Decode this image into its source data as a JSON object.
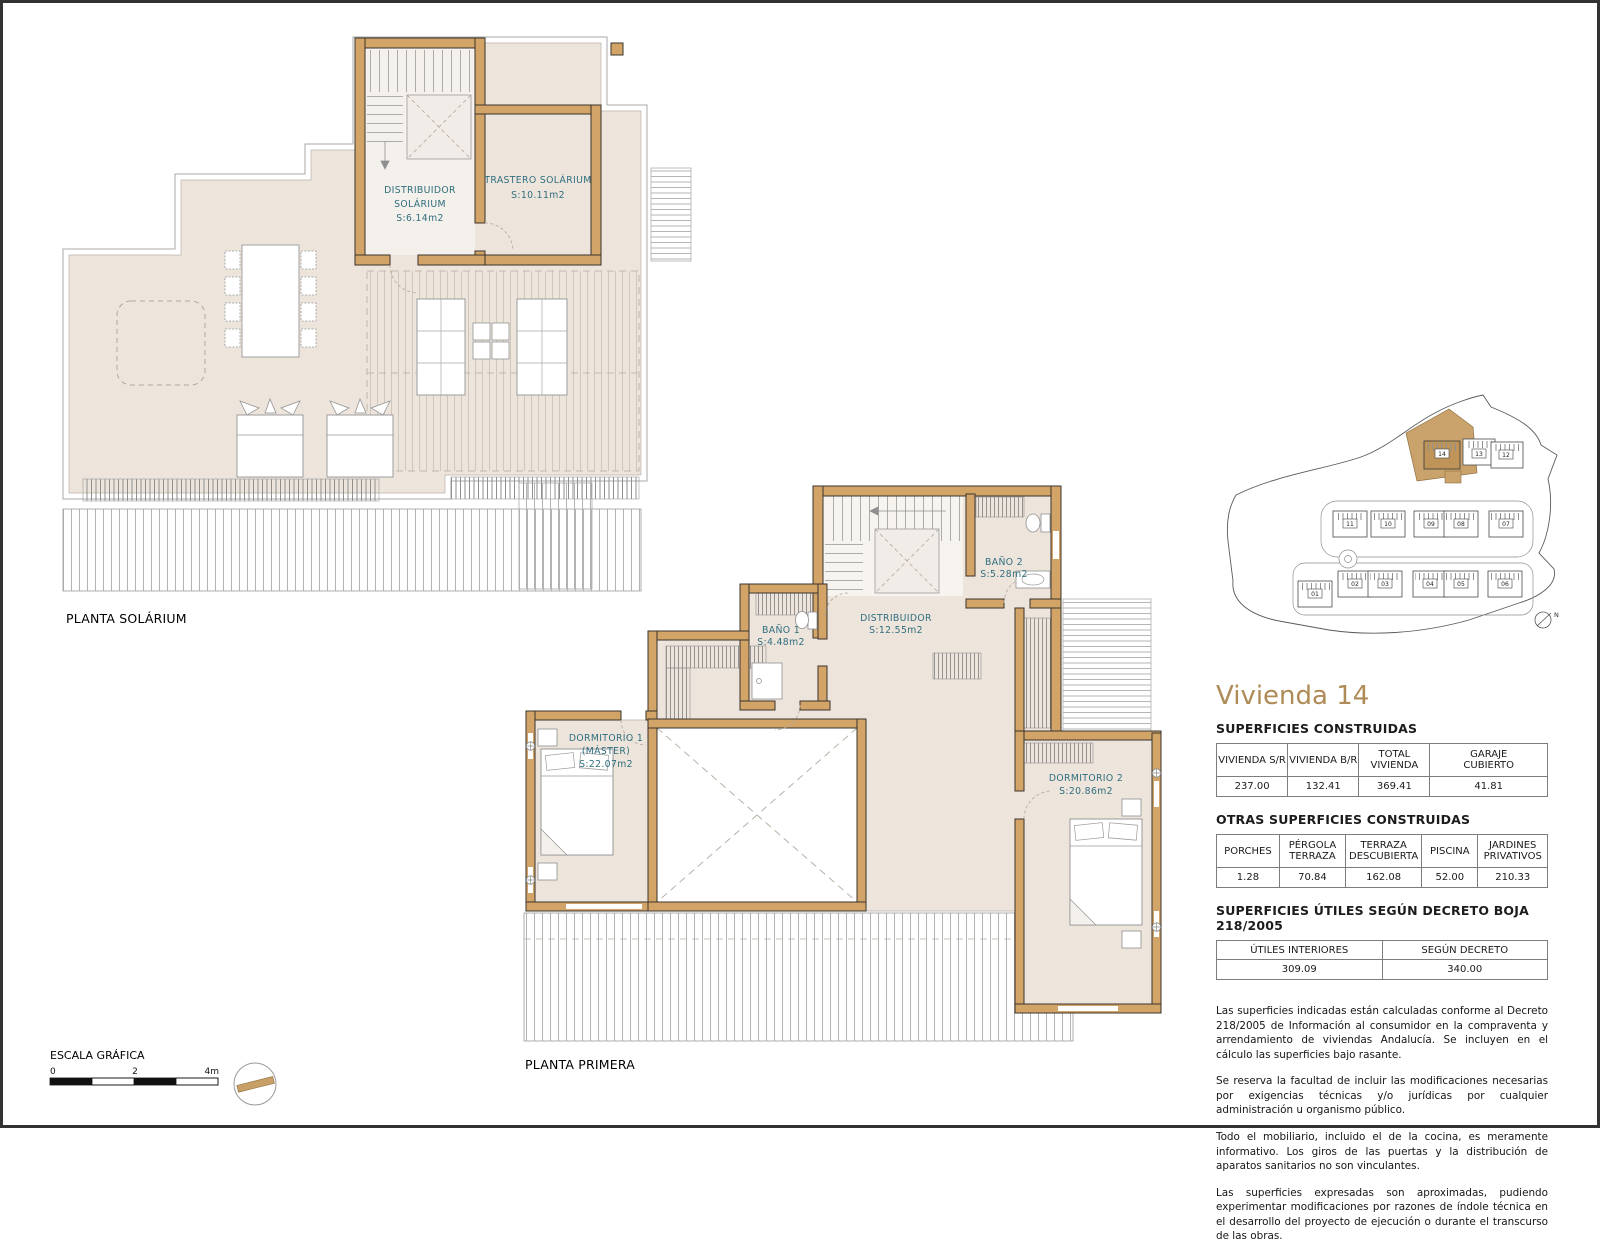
{
  "plans": {
    "solarium": {
      "title": "PLANTA SOLÁRIUM",
      "distribuidor_l1": "DISTRIBUIDOR",
      "distribuidor_l2": "SOLÁRIUM",
      "distribuidor_area": "S:6.14m2",
      "trastero_name": "TRASTERO SOLÁRIUM",
      "trastero_area": "S:10.11m2"
    },
    "primera": {
      "title": "PLANTA PRIMERA",
      "dorm1_l1": "DORMITORIO 1",
      "dorm1_l2": "(MÁSTER)",
      "dorm1_area": "S:22.07m2",
      "bano1_name": "BAÑO 1",
      "bano1_area": "S:4.48m2",
      "distribuidor_name": "DISTRIBUIDOR",
      "distribuidor_area": "S:12.55m2",
      "bano2_name": "BAÑO 2",
      "bano2_area": "S:5.28m2",
      "dorm2_name": "DORMITORIO 2",
      "dorm2_area": "S:20.86m2"
    }
  },
  "site": {
    "units": [
      "01",
      "02",
      "03",
      "04",
      "05",
      "06",
      "07",
      "08",
      "09",
      "10",
      "11",
      "12",
      "13",
      "14"
    ],
    "highlighted_unit": "14",
    "north_label": "N"
  },
  "scale": {
    "label": "ESCALA GRÁFICA",
    "tick_0": "0",
    "tick_2": "2",
    "tick_4": "4m"
  },
  "info": {
    "title": "Vivienda 14",
    "section1": "SUPERFICIES CONSTRUIDAS",
    "table1": {
      "headers": [
        "VIVIENDA S/R",
        "VIVIENDA B/R",
        "TOTAL\nVIVIENDA",
        "GARAJE\nCUBIERTO"
      ],
      "values": [
        "237.00",
        "132.41",
        "369.41",
        "41.81"
      ]
    },
    "section2": "OTRAS SUPERFICIES CONSTRUIDAS",
    "table2": {
      "headers": [
        "PORCHES",
        "PÉRGOLA\nTERRAZA",
        "TERRAZA\nDESCUBIERTA",
        "PISCINA",
        "JARDINES\nPRIVATIVOS"
      ],
      "values": [
        "1.28",
        "70.84",
        "162.08",
        "52.00",
        "210.33"
      ]
    },
    "section3": "SUPERFICIES ÚTILES SEGÚN DECRETO BOJA 218/2005",
    "table3": {
      "headers": [
        "ÚTILES INTERIORES",
        "SEGÚN DECRETO"
      ],
      "values": [
        "309.09",
        "340.00"
      ]
    },
    "notes": [
      "Las superficies indicadas están calculadas conforme al Decreto 218/2005 de Información al consumidor en la compraventa y arrendamiento de viviendas Andalucía. Se incluyen en el cálculo las superficies bajo rasante.",
      "Se reserva la facultad de incluir las modificaciones necesarias por exigencias técnicas y/o jurídicas por cualquier administración u organismo público.",
      "Todo el mobiliario, incluido el de la cocina, es meramente informativo. Los giros de las puertas y la distribución de aparatos sanitarios no son vinculantes.",
      "Las superficies expresadas son aproximadas, pudiendo experimentar modificaciones por razones de índole técnica en el desarrollo del proyecto de ejecución o durante el transcurso de las obras."
    ]
  },
  "colors": {
    "accent": "#AE8B57",
    "wall": "#D2A468",
    "floor": "#EDE4DC",
    "room_label": "#2F6E7E"
  }
}
